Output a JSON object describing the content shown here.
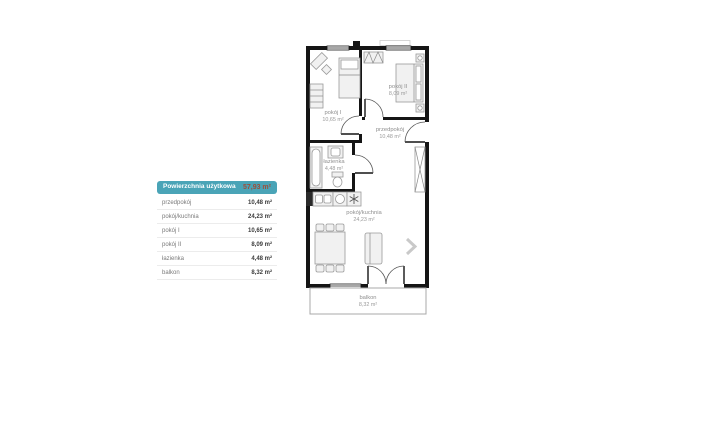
{
  "legend": {
    "header": {
      "label": "Powierzchnia użytkowa",
      "value": "57,93 m²"
    },
    "rows": [
      {
        "label": "przedpokój",
        "value": "10,48 m²"
      },
      {
        "label": "pokój/kuchnia",
        "value": "24,23 m²"
      },
      {
        "label": "pokój I",
        "value": "10,65 m²"
      },
      {
        "label": "pokój II",
        "value": "8,09 m²"
      },
      {
        "label": "łazienka",
        "value": "4,48 m²"
      },
      {
        "label": "balkon",
        "value": "8,32 m²"
      }
    ]
  },
  "floorplan": {
    "rooms": {
      "pokoj1": {
        "name": "pokój I",
        "area": "10,65 m²"
      },
      "pokoj2": {
        "name": "pokój II",
        "area": "8,09 m²"
      },
      "przedpokoj": {
        "name": "przedpokój",
        "area": "10,48 m²"
      },
      "lazienka": {
        "name": "łazienka",
        "area": "4,48 m²"
      },
      "salon": {
        "name": "pokój/kuchnia",
        "area": "24,23 m²"
      },
      "balkon": {
        "name": "balkon",
        "area": "8,32 m²"
      }
    }
  },
  "colors": {
    "accent_teal": "#4aa4b7",
    "accent_value": "#9c4f3c",
    "wall": "#151515"
  }
}
